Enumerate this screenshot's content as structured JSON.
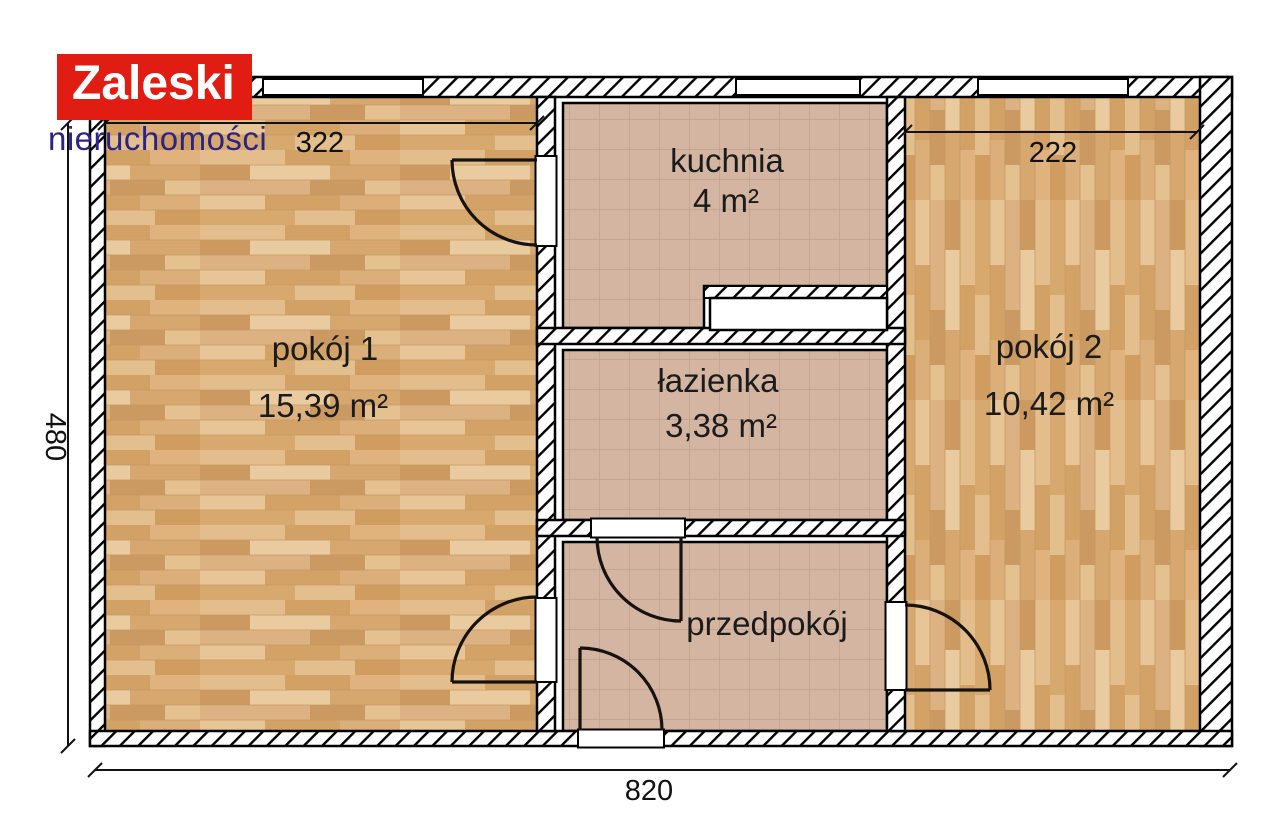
{
  "brand": {
    "name": "Zaleski",
    "subtitle": "nieruchomości"
  },
  "rooms": {
    "pokoj1": {
      "name": "pokój 1",
      "area": "15,39 m²"
    },
    "kuchnia": {
      "name": "kuchnia",
      "area": "4 m²"
    },
    "lazienka": {
      "name": "łazienka",
      "area": "3,38 m²"
    },
    "przedpokoj": {
      "name": "przedpokój"
    },
    "pokoj2": {
      "name": "pokój 2",
      "area": "10,42 m²"
    }
  },
  "dimensions": {
    "room1_width": "322",
    "room2_width": "222",
    "plan_height": "480",
    "plan_width": "820"
  },
  "colors": {
    "logo_background": "#e11d13",
    "logo_text": "#ffffff",
    "logo_subtitle": "#2c2386",
    "wood_floor_base": "#dcaf7d",
    "tile_floor_base": "#d3b5a1",
    "plan_lines": "#000000"
  }
}
